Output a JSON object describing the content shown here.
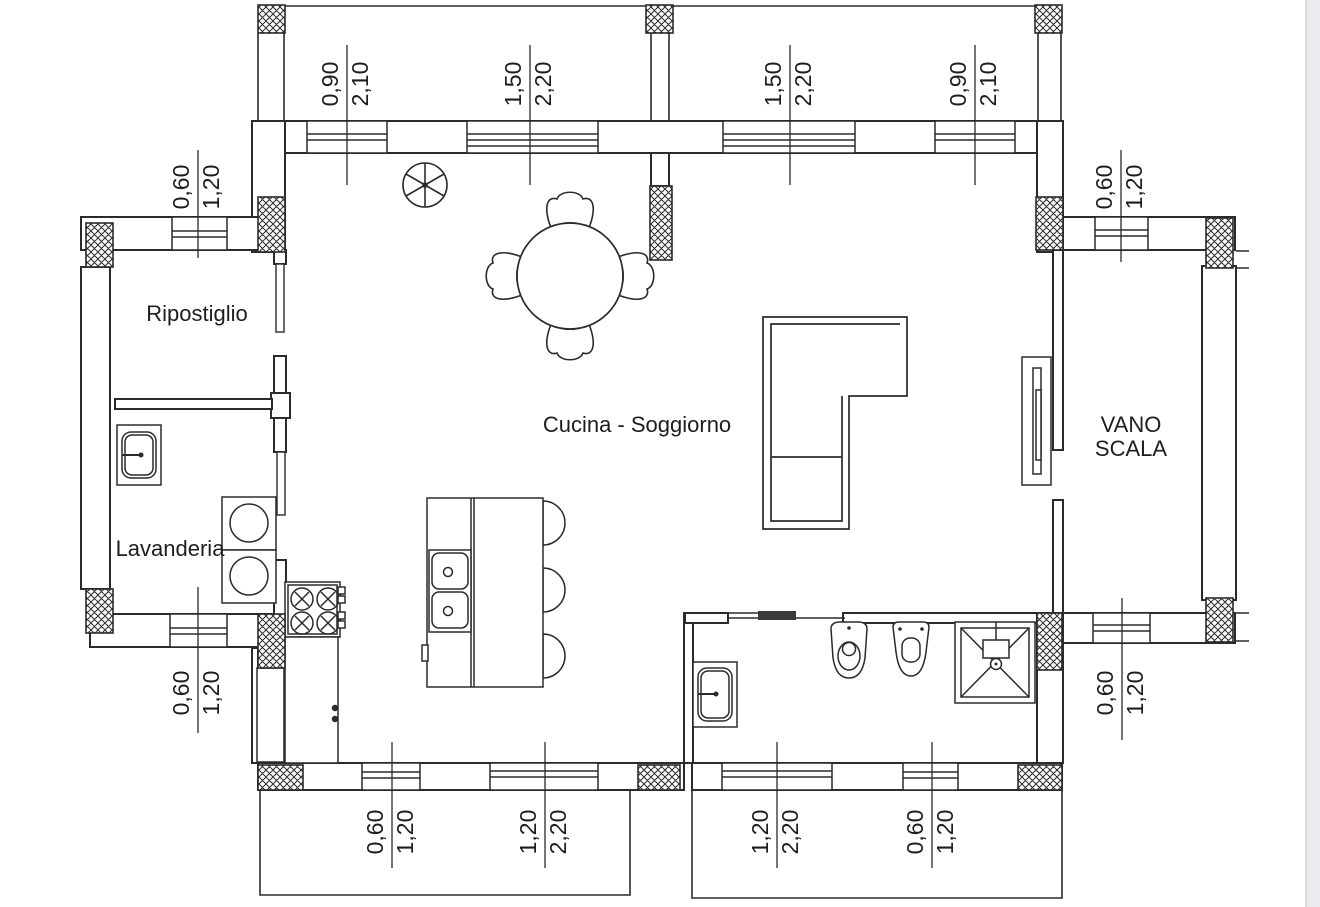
{
  "drawing": {
    "type": "residential-floor-plan",
    "rooms": {
      "ripostiglio": "Ripostiglio",
      "lavanderia": "Lavanderia",
      "cucina_soggiorno": "Cucina - Soggiorno",
      "vano_scala_line1": "VANO",
      "vano_scala_line2": "SCALA"
    },
    "dimensions": {
      "top": [
        {
          "width": "0,90",
          "height": "2,10"
        },
        {
          "width": "1,50",
          "height": "2,20"
        },
        {
          "width": "1,50",
          "height": "2,20"
        },
        {
          "width": "0,90",
          "height": "2,10"
        }
      ],
      "bottom": [
        {
          "width": "0,60",
          "height": "1,20"
        },
        {
          "width": "1,20",
          "height": "2,20"
        },
        {
          "width": "1,20",
          "height": "2,20"
        },
        {
          "width": "0,60",
          "height": "1,20"
        }
      ],
      "left_top": {
        "width": "0,60",
        "height": "1,20"
      },
      "left_bottom": {
        "width": "0,60",
        "height": "1,20"
      },
      "right_top": {
        "width": "0,60",
        "height": "1,20"
      },
      "right_bottom": {
        "width": "0,60",
        "height": "1,20"
      }
    },
    "fixtures": {
      "lamp": "ceiling-lamp-icon",
      "table": "round-dining-table-icon",
      "chairs": "dining-chair-icon",
      "sofa": "l-shaped-sofa-icon",
      "tv_unit": "tv-cabinet-icon",
      "island": "kitchen-island-icon",
      "island_sink": "double-sink-icon",
      "stools": "stool-icon",
      "cooktop": "four-burner-cooktop-icon",
      "counter": "kitchen-counter-icon",
      "tall_cabinet": "tall-cabinet-icon",
      "washers": "washing-machine-icon",
      "laundry_sink": "laundry-sink-icon",
      "bath_sink": "bathroom-sink-icon",
      "bidet": "bidet-icon",
      "toilet": "toilet-icon",
      "shower": "shower-box-icon",
      "sliding_door": "sliding-door-icon",
      "pillar": "masonry-pillar-hatch"
    },
    "colors": {
      "line": "#2b2b2b",
      "background": "#ffffff",
      "right_gutter": "#e9ebee",
      "door_panel": "#3a3a3a"
    }
  }
}
